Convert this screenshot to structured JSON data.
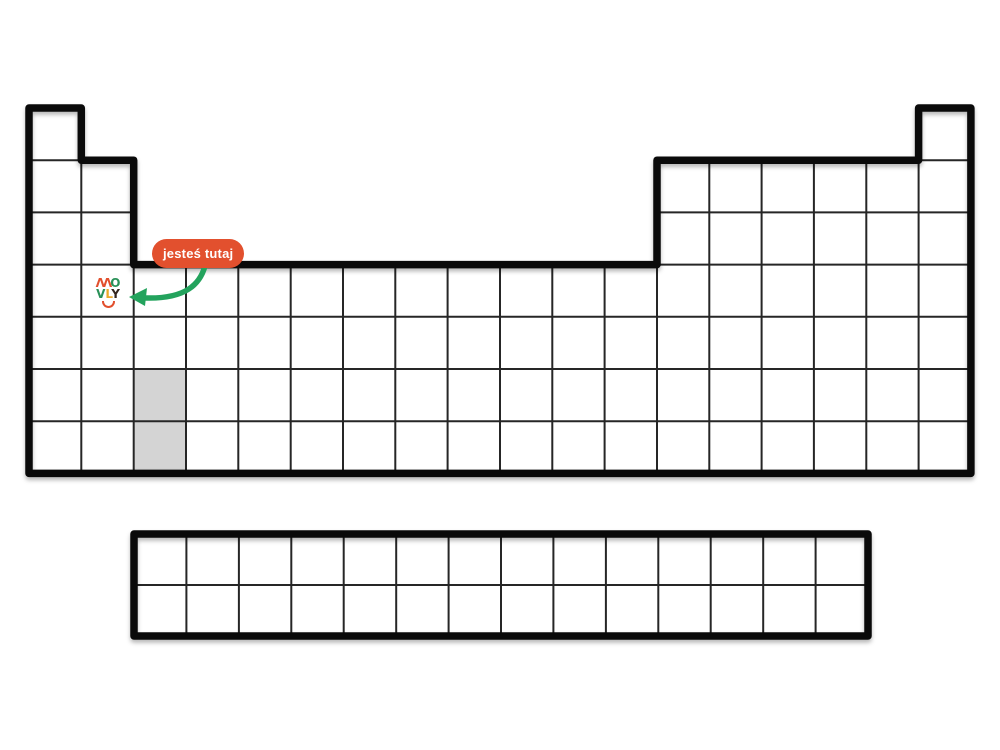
{
  "page": {
    "description": "Blank periodic table outline worksheet with a 'you are here' marker pointing at one cell",
    "language": "Polish"
  },
  "colors": {
    "page_bg": "#ffffff",
    "table_border": "#0a0a0a",
    "grid_line": "#262626",
    "cell_highlight": "#d4d4d4",
    "badge_bg": "#e2502e",
    "badge_text": "#ffffff",
    "arrow_green": "#23a35d",
    "logo_red": "#e2502e",
    "logo_green": "#2a9158",
    "logo_yellow": "#eda929",
    "logo_dark": "#33251d"
  },
  "badge": {
    "label": "jesteś tutaj"
  },
  "logo": {
    "name": "MOVLY",
    "m": "ΛΛ",
    "o": "O",
    "v": "V",
    "l": "L",
    "y": "Y"
  },
  "table": {
    "main_block": {
      "columns": 18,
      "rows": 7,
      "row_1_occupied_columns": "1 and 18",
      "rows_2_3_occupied_columns": "1-2 and 13-18",
      "rows_4_7_occupied_columns": "1-18",
      "shaded_cells": [
        {
          "row": 6,
          "column": 3
        },
        {
          "row": 7,
          "column": 3
        }
      ],
      "marked_cell": {
        "row": 4,
        "column": 2,
        "marker": "MOVLY logo"
      }
    },
    "f_block": {
      "columns": 14,
      "rows": 2,
      "aligned_under_main_columns": "3-16"
    }
  }
}
